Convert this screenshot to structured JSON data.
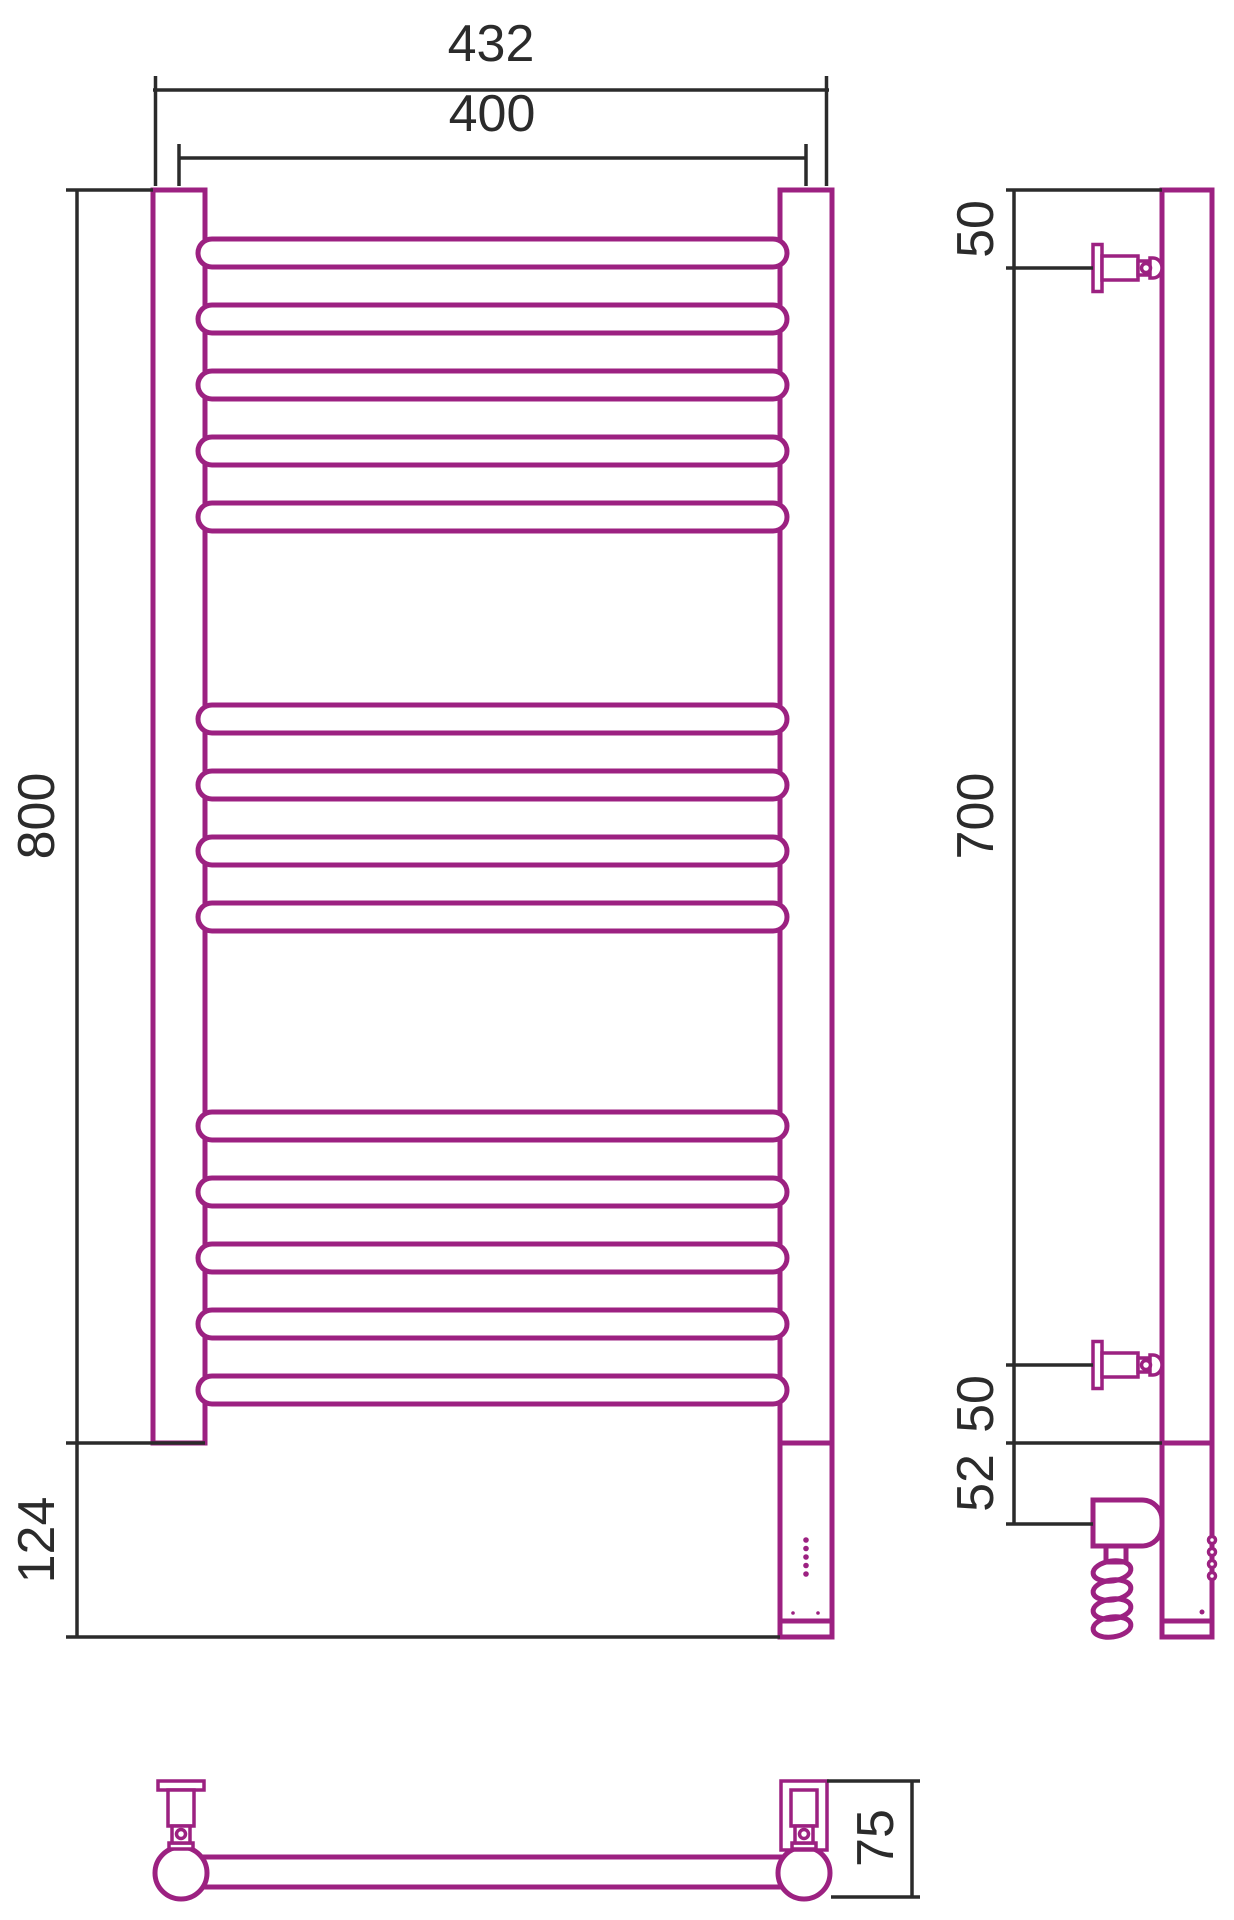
{
  "drawing": {
    "title": "heated-towel-rail-technical-drawing",
    "canvas": {
      "width": 1234,
      "height": 1920
    },
    "colors": {
      "product": "#9c2181",
      "dimension": "#2b2b2b",
      "background": "#ffffff"
    },
    "front_view": {
      "posts": [
        {
          "name": "left-post",
          "x": 153,
          "y": 190,
          "w": 52,
          "h": 1253
        },
        {
          "name": "right-post",
          "x": 780,
          "y": 190,
          "w": 52,
          "h": 1253
        }
      ],
      "rungs": {
        "x": 198,
        "w": 589,
        "h": 28,
        "tops": [
          239,
          305,
          371,
          437,
          503,
          705,
          771,
          837,
          903,
          1112,
          1178,
          1244,
          1310,
          1376
        ]
      },
      "heater_housing": {
        "x": 780,
        "y": 1443,
        "w": 52,
        "h": 194
      },
      "housing_cap_line": [
        780,
        1621,
        832,
        1621
      ],
      "led_indicators": {
        "x": 806,
        "ys": [
          1540,
          1548.5,
          1557,
          1565.5,
          1574
        ],
        "r": 2.8
      },
      "small_dots": {
        "points": [
          [
            793,
            1613
          ],
          [
            818,
            1613
          ]
        ],
        "r": 1.8
      }
    },
    "side_view": {
      "tube": {
        "x": 1162,
        "y": 190,
        "w": 50,
        "h": 1447
      },
      "joint_line": [
        1162,
        1443,
        1212,
        1443
      ],
      "cap_line": [
        1162,
        1621,
        1212,
        1621
      ],
      "brackets": {
        "axes": [
          268,
          1365
        ],
        "flange": {
          "x": 1093,
          "w": 9,
          "hh": 23.5
        },
        "body": {
          "x": 1102,
          "w": 36,
          "hh": 12
        },
        "neck": {
          "x": 1138,
          "w": 12,
          "hh": 7
        },
        "collar": {
          "x": 1150,
          "w": 12,
          "hh": 10
        },
        "screw": {
          "cx": 1146,
          "r": 4.5
        }
      },
      "heater_body": {
        "x": 1093,
        "y": 1500,
        "w": 69,
        "h": 46,
        "r": 20
      },
      "cable_neck": {
        "x": 1106,
        "y": 1546,
        "w": 20,
        "h": 16
      },
      "cable_coil": {
        "cx": 1112,
        "rx": 19,
        "ry": 10,
        "cys": [
          1571,
          1590,
          1609,
          1627
        ],
        "tilt": -8
      },
      "tube_bumps": {
        "x": 1212,
        "ys": [
          1540,
          1552,
          1564,
          1576
        ],
        "r": 3.5
      },
      "tube_dot": {
        "cx": 1202,
        "cy": 1612,
        "r": 2.5
      }
    },
    "bottom_view": {
      "bar": {
        "x": 200,
        "y": 1857,
        "w": 586,
        "h": 30
      },
      "collectors": [
        {
          "cx": 181,
          "cy": 1873,
          "r": 26
        },
        {
          "cx": 804,
          "cy": 1873,
          "r": 26
        }
      ],
      "brackets": [
        {
          "name": "bottom-view-left-bracket",
          "plate": {
            "x": 158,
            "y": 1781,
            "w": 46,
            "h": 9
          },
          "stem": {
            "x": 168,
            "y": 1790,
            "w": 26,
            "h": 36
          },
          "collar": {
            "x": 172,
            "y": 1826,
            "w": 18,
            "h": 17
          },
          "screw": {
            "cx": 181,
            "cy": 1834,
            "r": 4.5
          },
          "cone": {
            "x": 169,
            "y": 1843,
            "w": 24,
            "h": 6
          }
        },
        {
          "name": "bottom-view-right-bracket",
          "box": {
            "x": 781,
            "y": 1781,
            "w": 46,
            "h": 69
          },
          "stem": {
            "x": 791,
            "y": 1790,
            "w": 26,
            "h": 36
          },
          "collar": {
            "x": 795,
            "y": 1826,
            "w": 18,
            "h": 17
          },
          "screw": {
            "cx": 804,
            "cy": 1834,
            "r": 4.5
          },
          "cone": {
            "x": 792,
            "y": 1843,
            "w": 24,
            "h": 6
          }
        }
      ]
    },
    "dimensions": [
      {
        "id": "overall-width",
        "label": "432",
        "text": [
          491,
          44
        ],
        "rotated": false,
        "segments": [
          [
            153,
            90,
            829,
            90
          ],
          [
            155.5,
            76,
            155.5,
            186
          ],
          [
            826.5,
            76,
            826.5,
            186
          ]
        ]
      },
      {
        "id": "rail-width",
        "label": "400",
        "text": [
          492,
          114
        ],
        "rotated": false,
        "segments": [
          [
            179,
            158,
            806,
            158
          ],
          [
            179,
            144,
            179,
            186
          ],
          [
            806,
            144,
            806,
            186
          ]
        ]
      },
      {
        "id": "height",
        "label": "800",
        "text": [
          37,
          816
        ],
        "rotated": true,
        "segments": [
          [
            77,
            190,
            77,
            1443
          ],
          [
            66,
            190,
            153,
            190
          ],
          [
            66,
            1443,
            205,
            1443
          ]
        ]
      },
      {
        "id": "lower-section",
        "label": "124",
        "text": [
          37,
          1540
        ],
        "rotated": true,
        "segments": [
          [
            77,
            1443,
            77,
            1637
          ],
          [
            66,
            1637,
            780,
            1637
          ]
        ]
      },
      {
        "id": "top-offset",
        "label": "50",
        "text": [
          976,
          229
        ],
        "rotated": true,
        "segments": [
          [
            1014,
            190,
            1014,
            268
          ],
          [
            1006,
            190,
            1162,
            190
          ],
          [
            1006,
            268,
            1093,
            268
          ]
        ]
      },
      {
        "id": "bracket-span",
        "label": "700",
        "text": [
          976,
          816
        ],
        "rotated": true,
        "segments": [
          [
            1014,
            268,
            1014,
            1365
          ],
          [
            1006,
            1365,
            1093,
            1365
          ]
        ]
      },
      {
        "id": "bottom-offset",
        "label": "50",
        "text": [
          976,
          1404
        ],
        "rotated": true,
        "segments": [
          [
            1014,
            1365,
            1014,
            1443
          ],
          [
            1006,
            1443,
            1162,
            1443
          ]
        ]
      },
      {
        "id": "heater-offset",
        "label": "52",
        "text": [
          976,
          1483
        ],
        "rotated": true,
        "segments": [
          [
            1014,
            1443,
            1014,
            1524
          ],
          [
            1006,
            1524,
            1093,
            1524
          ]
        ]
      },
      {
        "id": "depth",
        "label": "75",
        "text": [
          876,
          1838
        ],
        "rotated": true,
        "segments": [
          [
            912,
            1781,
            912,
            1897
          ],
          [
            827,
            1781,
            920,
            1781
          ],
          [
            831,
            1897,
            920,
            1897
          ]
        ]
      }
    ]
  }
}
